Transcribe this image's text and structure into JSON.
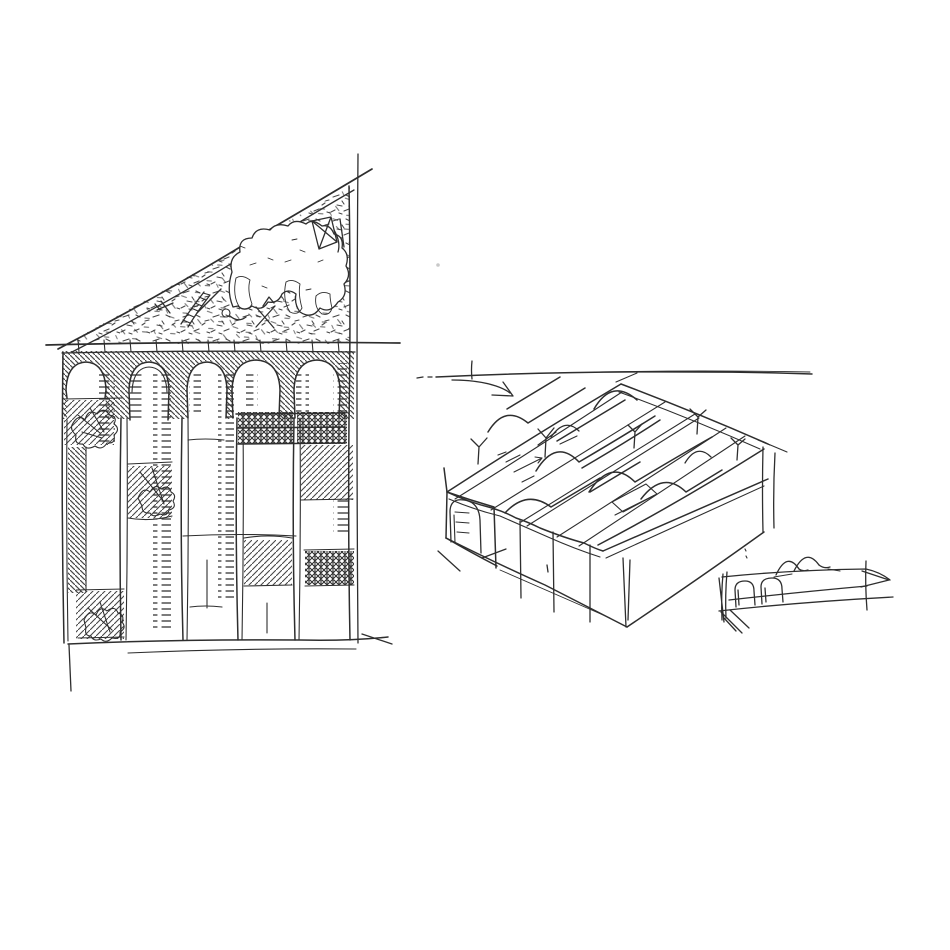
{
  "canvas": {
    "background": "#ffffff",
    "ink": "#2e2e2e",
    "smudge": "#c8c8c8"
  },
  "artwork": {
    "type": "freehand architectural pen sketch",
    "figures": [
      {
        "id": "section-sketch",
        "position": "left",
        "label": "section: five-bay arcade with hatched piers and infill panels beneath sloped ground fill with buried debris (ladder, figures, kite, excavated pocket)"
      },
      {
        "id": "axonometric-sketch",
        "position": "center-right",
        "label": "axonometric of long hall with barrel-vaulted roof bays, arched end opening and annotation arrow on horizon line"
      },
      {
        "id": "elevation-thumbnail",
        "position": "bottom-right",
        "label": "thumbnail elevation strip with two arched openings and twin vault profiles"
      }
    ]
  }
}
